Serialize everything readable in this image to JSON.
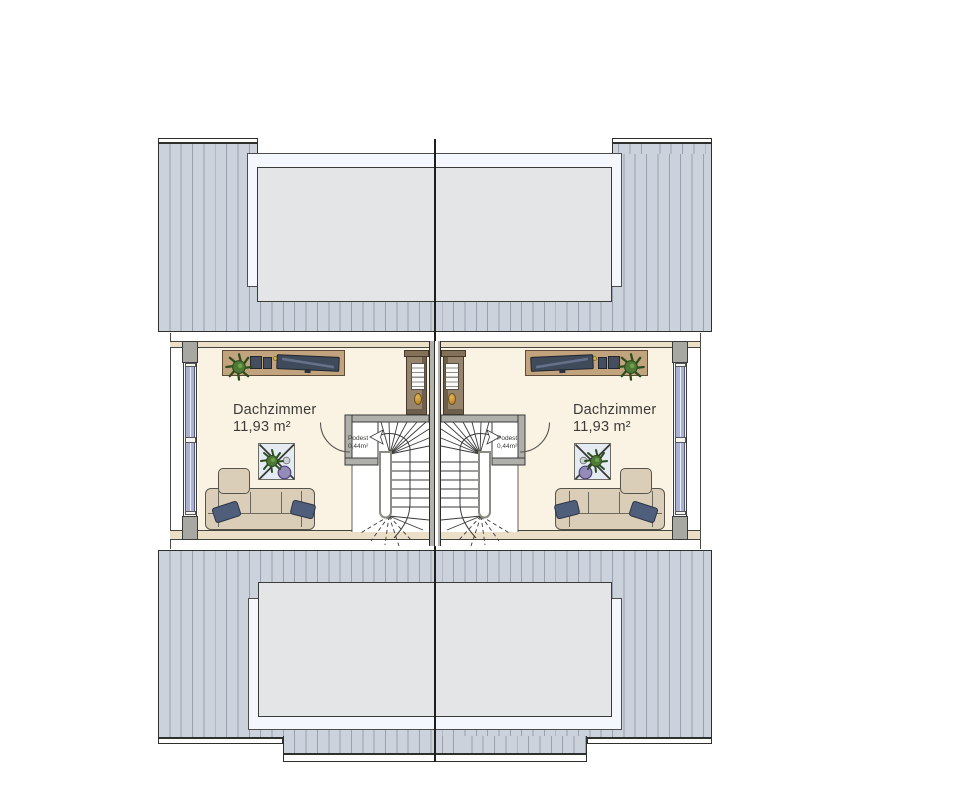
{
  "plan": {
    "floor_name": "attic-floor-plan",
    "rooms": [
      {
        "side": "left",
        "label": "Dachzimmer",
        "area": "11,93 m²",
        "landing": {
          "label": "Podest",
          "area": "0,44m²"
        },
        "furniture": [
          "tv-sideboard",
          "plant",
          "shelf-cabinet",
          "side-table-with-plant",
          "sofa-with-chaise",
          "winder-staircase",
          "door-swing",
          "knee-wall-window"
        ]
      },
      {
        "side": "right",
        "label": "Dachzimmer",
        "area": "11,93 m²",
        "landing": {
          "label": "Podest",
          "area": "0,44m²"
        },
        "furniture": [
          "tv-sideboard",
          "plant",
          "shelf-cabinet",
          "side-table-with-plant",
          "sofa-with-chaise",
          "winder-staircase",
          "door-swing",
          "knee-wall-window"
        ]
      }
    ],
    "roof": {
      "top_skylights": 1,
      "bottom_skylights": 1,
      "hatch": "vertical-stripes"
    },
    "colors": {
      "roof_fill": "#ccd2dc",
      "roof_stripe": "#98a0ae",
      "skylight_frame": "#f4f7fd",
      "skylight_pane": "#e3e5e7",
      "floor": "#faf3e3",
      "wall_band": "#ebdfc8",
      "wall_gray": "#a8a8a2",
      "window_glass": "#a9b1d5",
      "party_wall": "#b3b3ad",
      "wood": "#c1a47e",
      "wood_dark": "#96846c",
      "sofa": "#dbceb8",
      "pillow": "#4f5e7a",
      "tv": "#3f4a5b",
      "plant": "#4e7a36",
      "pot": "#958bb8",
      "amber": "#c9952f",
      "table": "#e4ebf2",
      "line": "#3a3a38"
    }
  }
}
